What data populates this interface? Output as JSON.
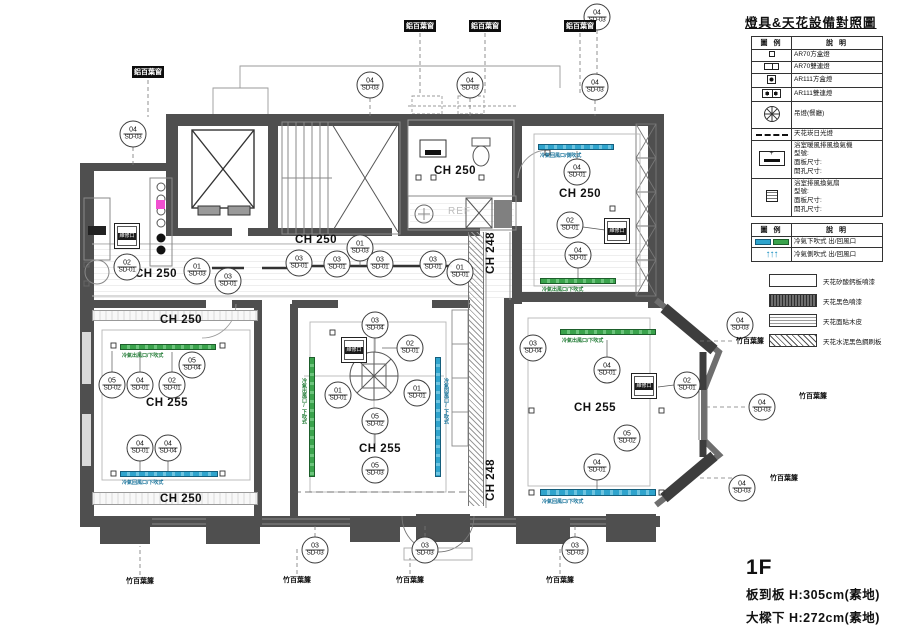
{
  "legend": {
    "title": "燈具&天花設備對照圖",
    "table1": {
      "headers": [
        "圖 例",
        "說  明"
      ],
      "rows": [
        {
          "icon": "square-light",
          "label": [
            "AR70方盒燈"
          ]
        },
        {
          "icon": "double-square-light",
          "label": [
            "AR70雙連燈"
          ]
        },
        {
          "icon": "ar111-light",
          "label": [
            "AR111方盒燈"
          ]
        },
        {
          "icon": "ar111-double-light",
          "label": [
            "AR111雙連燈"
          ]
        },
        {
          "icon": "chandelier",
          "label": [
            "吊燈(餐廳)"
          ]
        },
        {
          "icon": "dashed-line",
          "label": [
            "天花崁日光燈"
          ]
        },
        {
          "icon": "bath-heater",
          "label": [
            "浴室暖風排風換氣機",
            "型號:",
            "面板尺寸:",
            "開孔尺寸:"
          ]
        },
        {
          "icon": "vent-fan",
          "label": [
            "浴室排風換氣扇",
            "型號:",
            "面板尺寸:",
            "開孔尺寸:"
          ]
        }
      ]
    },
    "table2": {
      "headers": [
        "圖 例",
        "說  明"
      ],
      "rows": [
        {
          "icon": "linear-diffuser",
          "label": [
            "冷氣下吹式 出/回風口"
          ]
        },
        {
          "icon": "side-blow-arrows",
          "label": [
            "冷氣側吹式 出/回風口"
          ]
        }
      ]
    },
    "materials": [
      {
        "icon": "plain",
        "label": "天花矽酸鈣板噴漆"
      },
      {
        "icon": "dark-hatch",
        "label": "天花黑色噴漆"
      },
      {
        "icon": "wood",
        "label": "天花面貼木皮"
      },
      {
        "icon": "diag-hatch",
        "label": "天花水泥黑色鋼刷板"
      }
    ]
  },
  "titleblock": {
    "floor": "1F",
    "line1": "板到板 H:305cm(素地)",
    "line2": "大樑下 H:272cm(素地)"
  },
  "plan": {
    "ref_label": "REF",
    "panel_label": "維修口",
    "markers": [
      {
        "n": "04",
        "c": "SD-03",
        "x": 133,
        "y": 134
      },
      {
        "n": "04",
        "c": "SD-03",
        "x": 370,
        "y": 85
      },
      {
        "n": "04",
        "c": "SD-03",
        "x": 470,
        "y": 85
      },
      {
        "n": "04",
        "c": "SD-03",
        "x": 597,
        "y": 17
      },
      {
        "n": "04",
        "c": "SD-03",
        "x": 595,
        "y": 87
      },
      {
        "n": "04",
        "c": "SD-03",
        "x": 740,
        "y": 325
      },
      {
        "n": "04",
        "c": "SD-03",
        "x": 762,
        "y": 407
      },
      {
        "n": "04",
        "c": "SD-03",
        "x": 742,
        "y": 488
      },
      {
        "n": "03",
        "c": "SD-03",
        "x": 315,
        "y": 550
      },
      {
        "n": "03",
        "c": "SD-03",
        "x": 425,
        "y": 550
      },
      {
        "n": "03",
        "c": "SD-03",
        "x": 575,
        "y": 550
      },
      {
        "n": "01",
        "c": "SD-03",
        "x": 197,
        "y": 271
      },
      {
        "n": "03",
        "c": "SD-01",
        "x": 228,
        "y": 281
      },
      {
        "n": "03",
        "c": "SD-01",
        "x": 299,
        "y": 263
      },
      {
        "n": "03",
        "c": "SD-01",
        "x": 337,
        "y": 264
      },
      {
        "n": "01",
        "c": "SD-03",
        "x": 360,
        "y": 248
      },
      {
        "n": "03",
        "c": "SD-01",
        "x": 380,
        "y": 264
      },
      {
        "n": "03",
        "c": "SD-01",
        "x": 433,
        "y": 264
      },
      {
        "n": "01",
        "c": "SD-01",
        "x": 460,
        "y": 272
      },
      {
        "n": "02",
        "c": "SD-01",
        "x": 127,
        "y": 267
      },
      {
        "n": "05",
        "c": "SD-02",
        "x": 112,
        "y": 385
      },
      {
        "n": "04",
        "c": "SD-01",
        "x": 140,
        "y": 385
      },
      {
        "n": "02",
        "c": "SD-01",
        "x": 172,
        "y": 385
      },
      {
        "n": "05",
        "c": "SD-04",
        "x": 192,
        "y": 365
      },
      {
        "n": "04",
        "c": "SD-01",
        "x": 140,
        "y": 448
      },
      {
        "n": "04",
        "c": "SD-04",
        "x": 168,
        "y": 448
      },
      {
        "n": "03",
        "c": "SD-04",
        "x": 375,
        "y": 325
      },
      {
        "n": "02",
        "c": "SD-01",
        "x": 410,
        "y": 348
      },
      {
        "n": "01",
        "c": "SD-01",
        "x": 338,
        "y": 395
      },
      {
        "n": "01",
        "c": "SD-01",
        "x": 417,
        "y": 393
      },
      {
        "n": "05",
        "c": "SD-02",
        "x": 375,
        "y": 421
      },
      {
        "n": "05",
        "c": "SD-03",
        "x": 375,
        "y": 470
      },
      {
        "n": "04",
        "c": "SD-01",
        "x": 577,
        "y": 172
      },
      {
        "n": "02",
        "c": "SD-01",
        "x": 570,
        "y": 225
      },
      {
        "n": "04",
        "c": "SD-01",
        "x": 578,
        "y": 255
      },
      {
        "n": "03",
        "c": "SD-04",
        "x": 533,
        "y": 348
      },
      {
        "n": "04",
        "c": "SD-01",
        "x": 607,
        "y": 370
      },
      {
        "n": "02",
        "c": "SD-01",
        "x": 687,
        "y": 385
      },
      {
        "n": "05",
        "c": "SD-02",
        "x": 627,
        "y": 438
      },
      {
        "n": "04",
        "c": "SD-01",
        "x": 597,
        "y": 467
      }
    ],
    "ch_labels": [
      {
        "t": "CH 250",
        "x": 156,
        "y": 274
      },
      {
        "t": "CH 250",
        "x": 316,
        "y": 240
      },
      {
        "t": "CH 250",
        "x": 455,
        "y": 171
      },
      {
        "t": "CH 250",
        "x": 580,
        "y": 194
      },
      {
        "t": "CH 250",
        "x": 181,
        "y": 320
      },
      {
        "t": "CH 255",
        "x": 167,
        "y": 403
      },
      {
        "t": "CH 250",
        "x": 181,
        "y": 499
      },
      {
        "t": "CH 255",
        "x": 380,
        "y": 449
      },
      {
        "t": "CH 255",
        "x": 595,
        "y": 408
      },
      {
        "t": "CH 248",
        "x": 491,
        "y": 253,
        "rot": true
      },
      {
        "t": "CH 248",
        "x": 491,
        "y": 480,
        "rot": true
      }
    ],
    "window_labels_dark": [
      {
        "t": "鋁百葉窗",
        "x": 148,
        "y": 72
      },
      {
        "t": "鋁百葉窗",
        "x": 420,
        "y": 26
      },
      {
        "t": "鋁百葉窗",
        "x": 485,
        "y": 26
      },
      {
        "t": "鋁百葉窗",
        "x": 580,
        "y": 26
      }
    ],
    "window_labels_plain": [
      {
        "t": "竹百葉簾",
        "x": 140,
        "y": 581
      },
      {
        "t": "竹百葉簾",
        "x": 297,
        "y": 580
      },
      {
        "t": "竹百葉簾",
        "x": 410,
        "y": 580
      },
      {
        "t": "竹百葉簾",
        "x": 560,
        "y": 580
      },
      {
        "t": "竹百葉簾",
        "x": 750,
        "y": 341
      },
      {
        "t": "竹百葉簾",
        "x": 813,
        "y": 396
      },
      {
        "t": "竹百葉簾",
        "x": 784,
        "y": 478
      }
    ],
    "air_bars": [
      {
        "x": 120,
        "y": 344,
        "w": 96,
        "h": 6,
        "color": "green",
        "vert": false,
        "label": "冷氣出風口/下吹式",
        "lx": 122,
        "ly": 352
      },
      {
        "x": 120,
        "y": 471,
        "w": 98,
        "h": 6,
        "color": "blue",
        "vert": false,
        "label": "冷氣回風口/下吹式",
        "lx": 122,
        "ly": 479
      },
      {
        "x": 309,
        "y": 357,
        "w": 6,
        "h": 120,
        "color": "green",
        "vert": true,
        "label": "冷氣出風口/下吹式",
        "lx": 301,
        "ly": 378
      },
      {
        "x": 435,
        "y": 357,
        "w": 6,
        "h": 120,
        "color": "blue",
        "vert": true,
        "label": "冷氣回風口/下吹式",
        "lx": 443,
        "ly": 378
      },
      {
        "x": 538,
        "y": 144,
        "w": 76,
        "h": 6,
        "color": "blue",
        "vert": false,
        "label": "冷氣回風口/側吹式",
        "lx": 540,
        "ly": 152
      },
      {
        "x": 540,
        "y": 278,
        "w": 76,
        "h": 6,
        "color": "green",
        "vert": false,
        "label": "冷氣出風口/下吹式",
        "lx": 542,
        "ly": 286
      },
      {
        "x": 560,
        "y": 329,
        "w": 96,
        "h": 6,
        "color": "green",
        "vert": false,
        "label": "冷氣出風口/下吹式",
        "lx": 562,
        "ly": 337
      },
      {
        "x": 540,
        "y": 489,
        "w": 116,
        "h": 7,
        "color": "blue",
        "vert": false,
        "label": "冷氣回風口/下吹式",
        "lx": 542,
        "ly": 498
      }
    ],
    "panels": [
      {
        "x": 127,
        "y": 236
      },
      {
        "x": 354,
        "y": 350
      },
      {
        "x": 617,
        "y": 231
      },
      {
        "x": 644,
        "y": 386
      }
    ]
  }
}
